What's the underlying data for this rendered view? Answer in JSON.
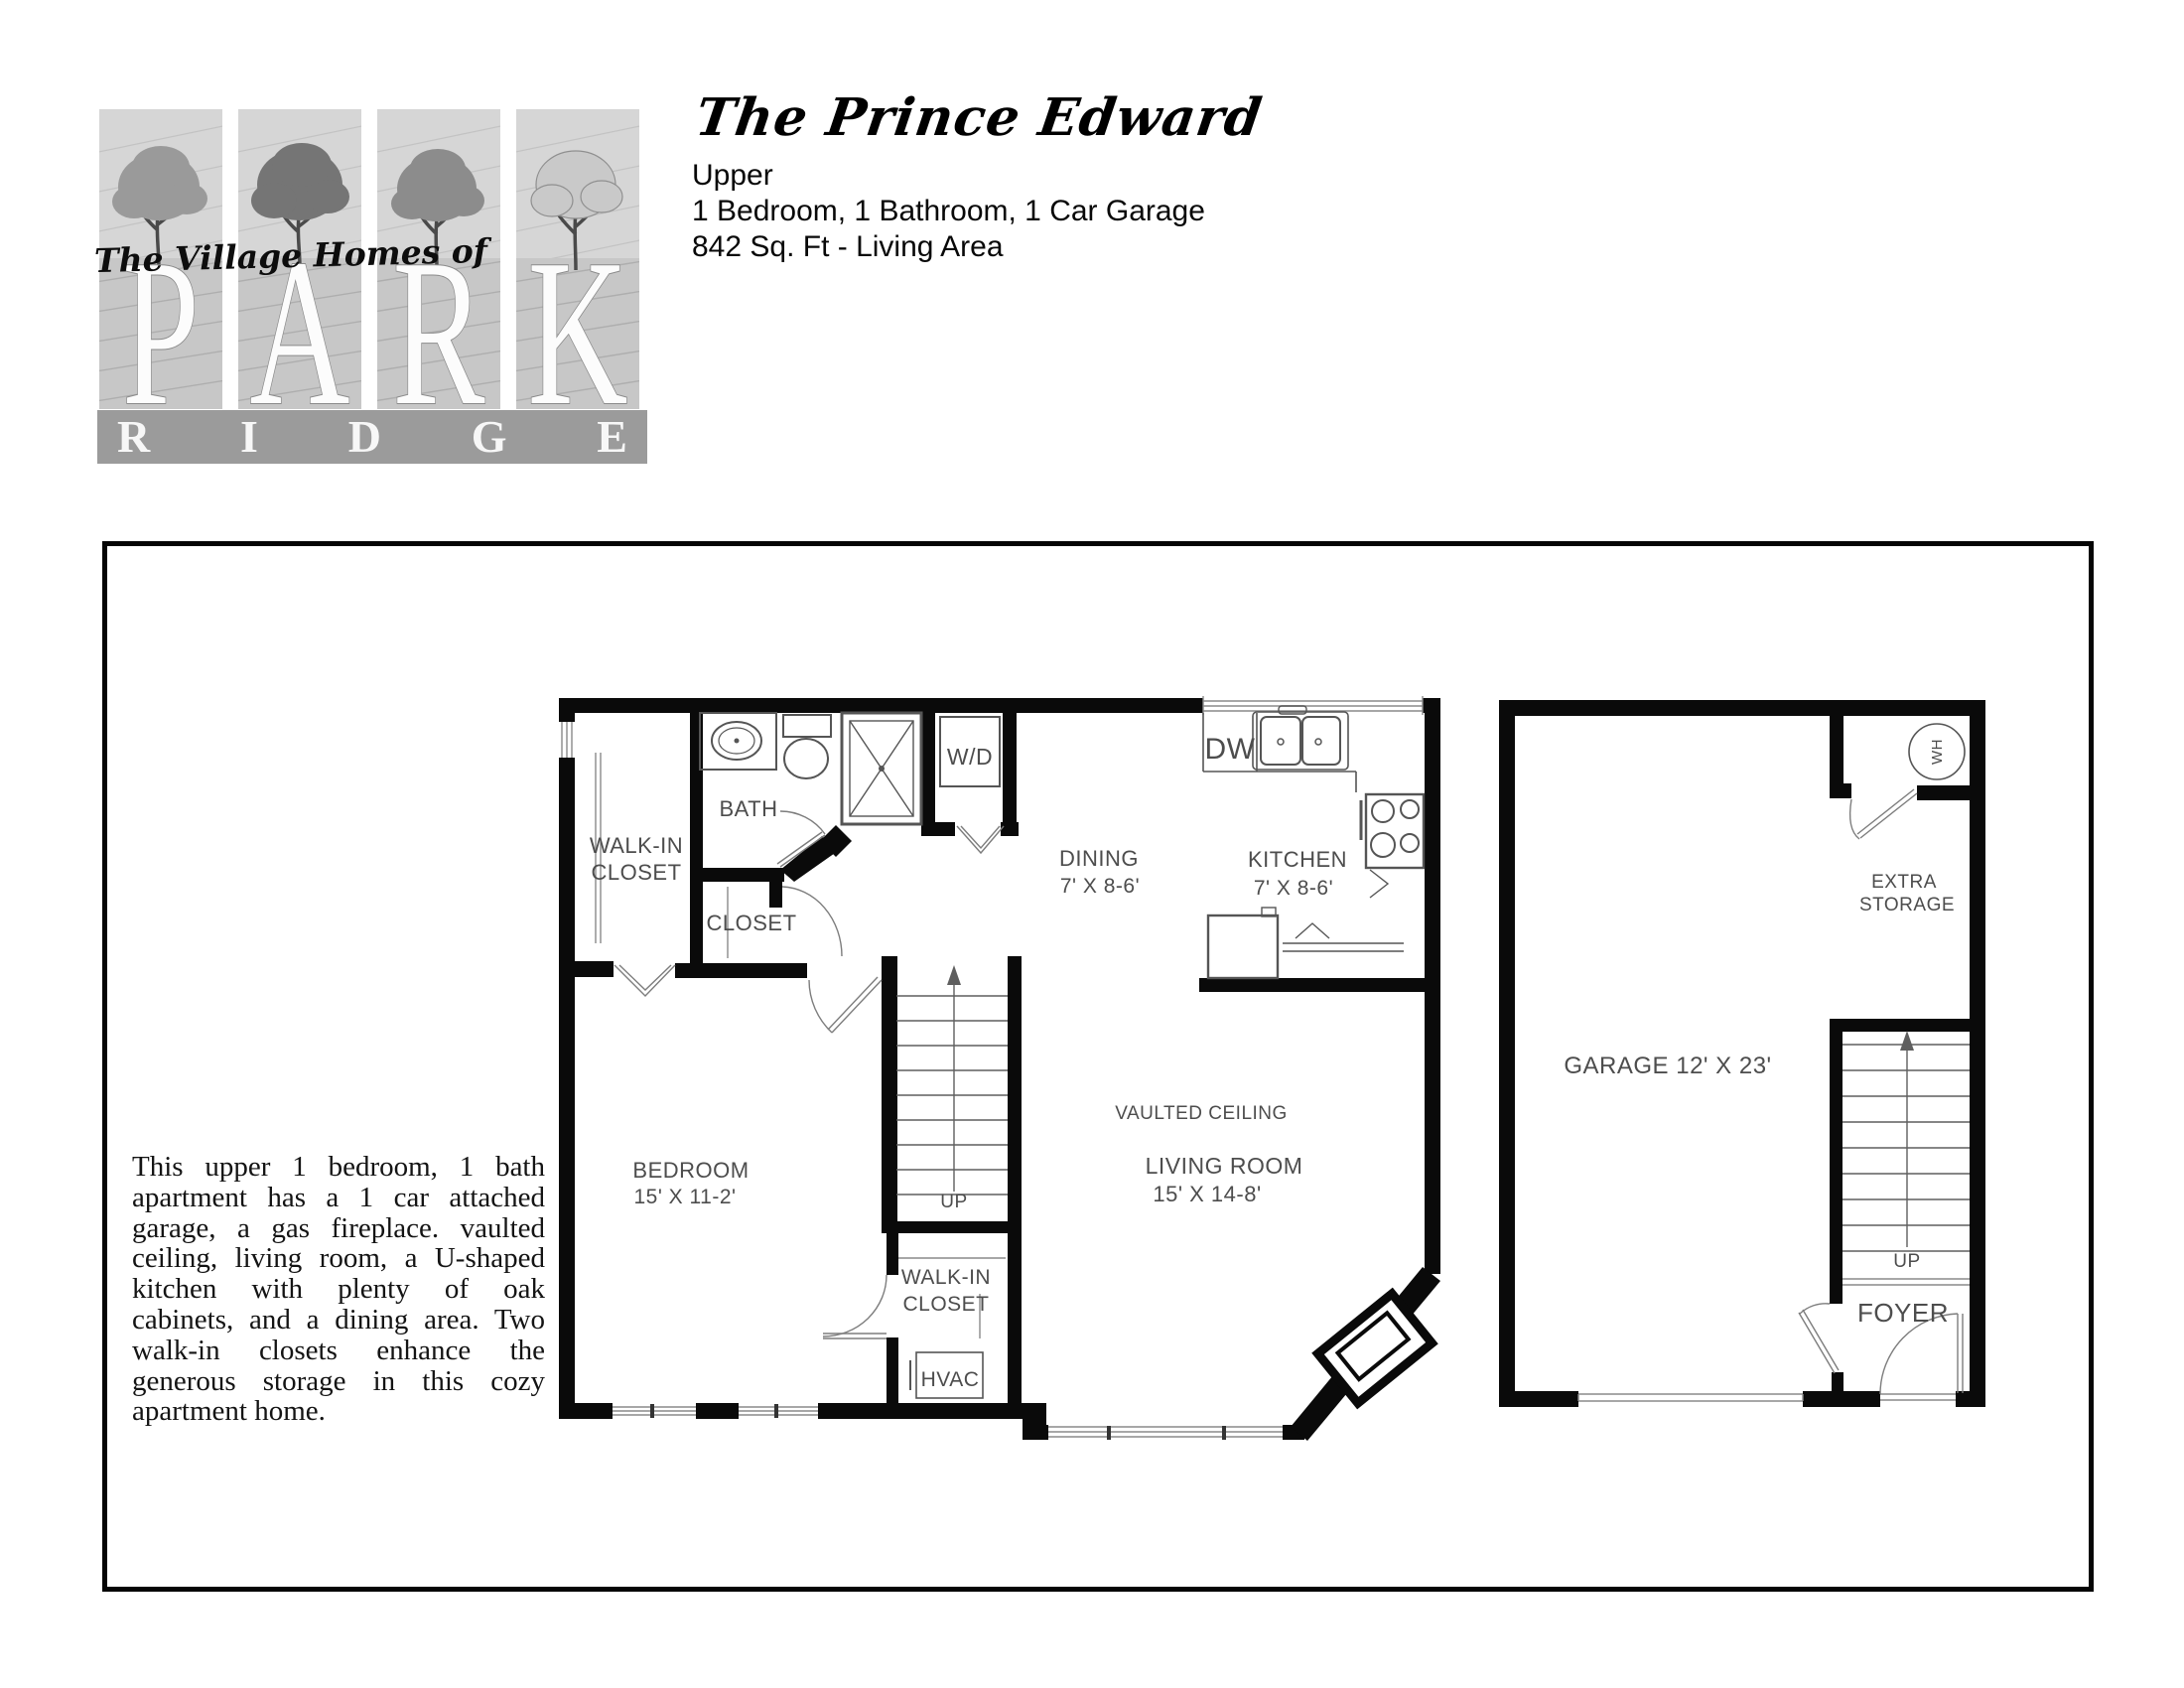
{
  "logo": {
    "tagline": "The Village Homes of",
    "park_letters": [
      "P",
      "A",
      "R",
      "K"
    ],
    "ridge_letters": [
      "R",
      "I",
      "D",
      "G",
      "E"
    ]
  },
  "header": {
    "title": "The Prince Edward",
    "floor": "Upper",
    "features": "1 Bedroom, 1 Bathroom, 1 Car Garage",
    "area": "842 Sq. Ft - Living Area"
  },
  "description": {
    "lines": [
      "This upper 1 bedroom, 1 bath",
      "apartment has a 1 car attached",
      "garage, a gas fireplace. vaulted",
      "ceiling, living room, a U-shaped",
      "kitchen with plenty of oak",
      "cabinets, and a dining area. Two",
      "walk-in closets enhance the",
      "generous storage in this cozy",
      "apartment home."
    ]
  },
  "floorplan_left": {
    "walkin_closet_top": {
      "line1": "WALK-IN",
      "line2": "CLOSET"
    },
    "bath": "BATH",
    "washer_dryer": "W/D",
    "closet": "CLOSET",
    "dishwasher": "DW",
    "dining": {
      "name": "DINING",
      "dims": "7' X 8-6'"
    },
    "kitchen": {
      "name": "KITCHEN",
      "dims": "7' X 8-6'"
    },
    "bedroom": {
      "name": "BEDROOM",
      "dims": "15' X 11-2'"
    },
    "stairs_up": "UP",
    "vaulted_ceiling": "VAULTED CEILING",
    "living_room": {
      "name": "LIVING ROOM",
      "dims": "15' X 14-8'"
    },
    "walkin_closet_bottom": {
      "line1": "WALK-IN",
      "line2": "CLOSET"
    },
    "hvac": "HVAC"
  },
  "floorplan_right": {
    "water_heater": "WH",
    "extra_storage": {
      "line1": "EXTRA",
      "line2": "STORAGE"
    },
    "garage": "GARAGE 12' X 23'",
    "stairs_up": "UP",
    "foyer": "FOYER"
  }
}
